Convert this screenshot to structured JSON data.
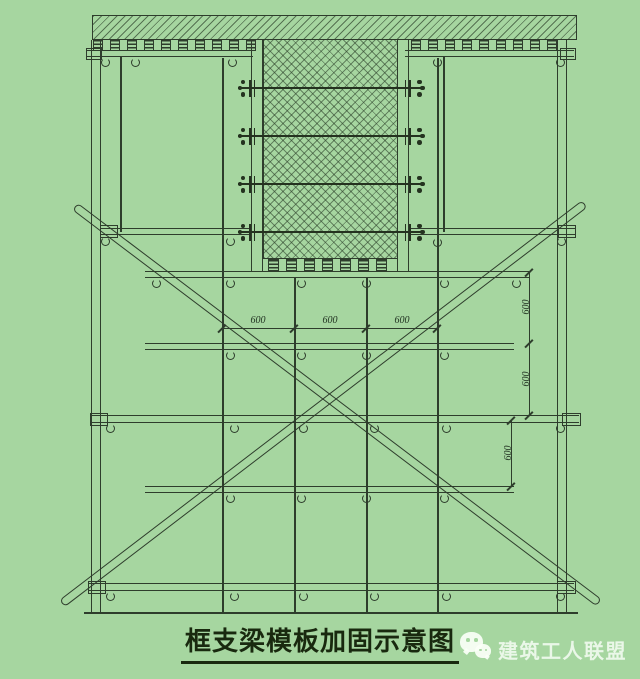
{
  "colors": {
    "background": "#a6d6a0",
    "line": "#2e3d2c",
    "caption_text": "#19290f",
    "watermark_text": "#f4fcf1"
  },
  "diagram": {
    "caption": "框支梁模板加固示意图",
    "dim_labels": {
      "horizontal": [
        "600",
        "600",
        "600"
      ],
      "vertical_upper": [
        "600",
        "600"
      ],
      "vertical_lower": [
        "600"
      ]
    }
  },
  "watermark": {
    "icon": "wechat-icon",
    "text": "建筑工人联盟"
  }
}
